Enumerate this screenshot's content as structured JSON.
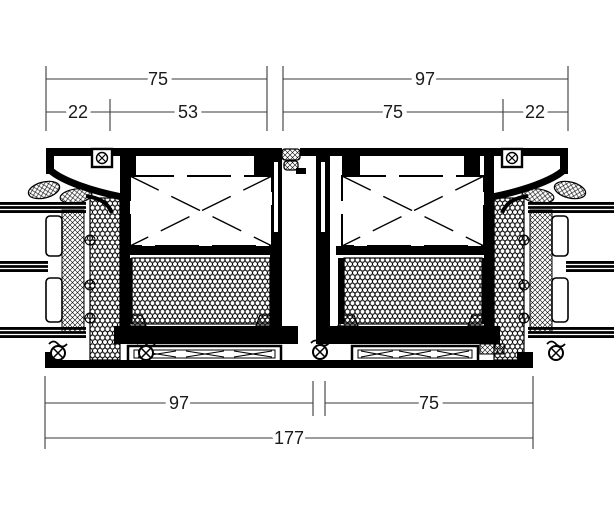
{
  "drawing": {
    "kind": "window-frame-coupling-horizontal-section",
    "colors": {
      "ink": "#000000",
      "dim_line": "#3a3a3a",
      "background": "#ffffff"
    },
    "dims": {
      "top": [
        {
          "label": "75"
        },
        {
          "label": "97"
        }
      ],
      "top_sub": [
        {
          "label": "22"
        },
        {
          "label": "53"
        },
        {
          "label": "75"
        },
        {
          "label": "22"
        }
      ],
      "bottom": [
        {
          "label": "97"
        },
        {
          "label": "75"
        }
      ],
      "total": {
        "label": "177"
      }
    }
  }
}
